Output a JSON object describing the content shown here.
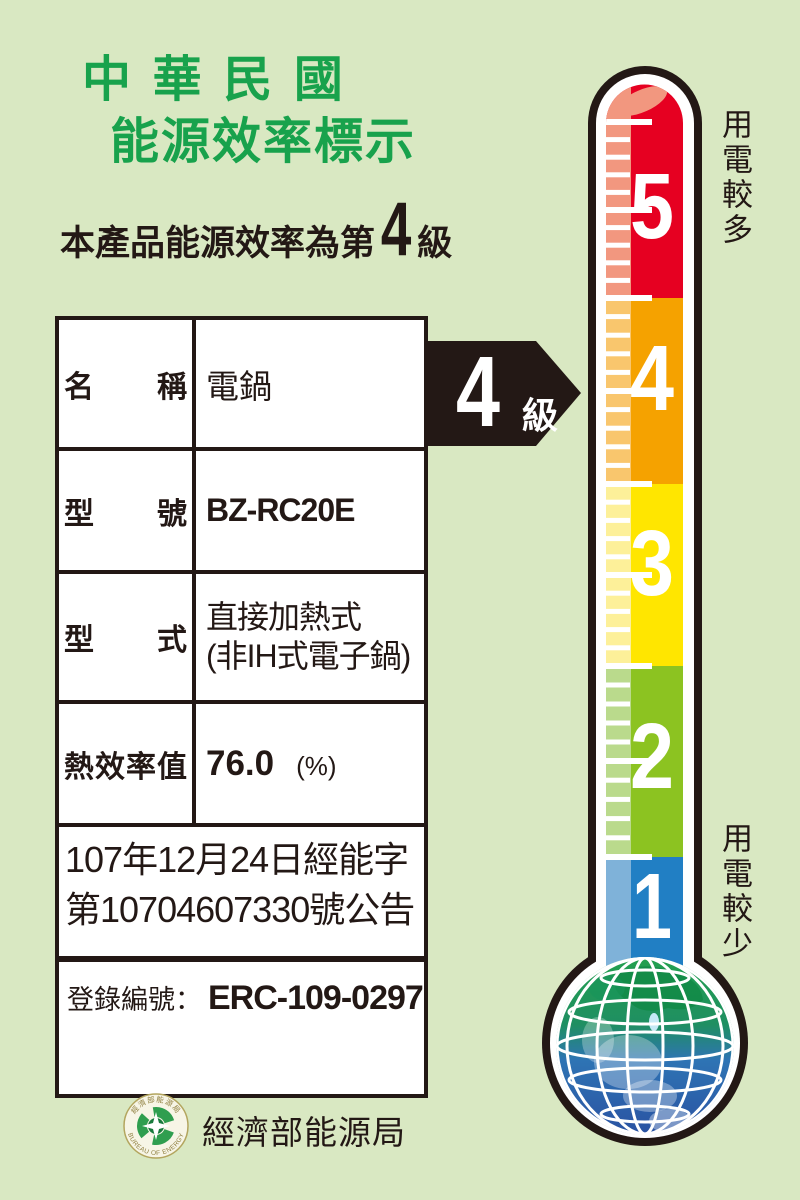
{
  "page": {
    "background_color": "#d9e8c2",
    "ink_color": "#231815",
    "title_color": "#18a24c",
    "title_line1": "中 華 民 國",
    "title_line2": "能源效率標示",
    "subtitle": {
      "prefix": "本產品能源效率為第",
      "grade": "4",
      "suffix": "級"
    }
  },
  "table": {
    "rows": [
      {
        "label": "名 稱",
        "value": "電鍋"
      },
      {
        "label": "型 號",
        "value": "BZ-RC20E"
      },
      {
        "label": "型 式",
        "value_line1": "直接加熱式",
        "value_line2": "(非IH式電子鍋)"
      },
      {
        "label": "熱效率值",
        "value": "76.0",
        "unit": "(%)"
      }
    ],
    "announcement_line1": "107年12月24日經能字",
    "announcement_line2": "第10704607330號公告",
    "registration_label": "登錄編號：",
    "registration_value": "ERC-109-0297"
  },
  "grade_arrow": {
    "number": "4",
    "suffix": "級",
    "fill": "#231815",
    "text_color": "#ffffff"
  },
  "thermometer": {
    "outline_color": "#231815",
    "label_more": "用電較多",
    "label_less": "用電較少",
    "levels": [
      {
        "number": "5",
        "color": "#e60021",
        "light_color": "#f2977f"
      },
      {
        "number": "4",
        "color": "#f5a200",
        "light_color": "#f9c66d"
      },
      {
        "number": "3",
        "color": "#ffe600",
        "light_color": "#fdf099"
      },
      {
        "number": "2",
        "color": "#8cc321",
        "light_color": "#bada8c"
      },
      {
        "number": "1",
        "color": "#217fc4",
        "light_color": "#7fb2d9"
      }
    ]
  },
  "footer": {
    "agency_name": "經濟部能源局",
    "seal_text_top": "經濟部能源局",
    "seal_text_bottom": "BUREAU OF ENERGY"
  }
}
